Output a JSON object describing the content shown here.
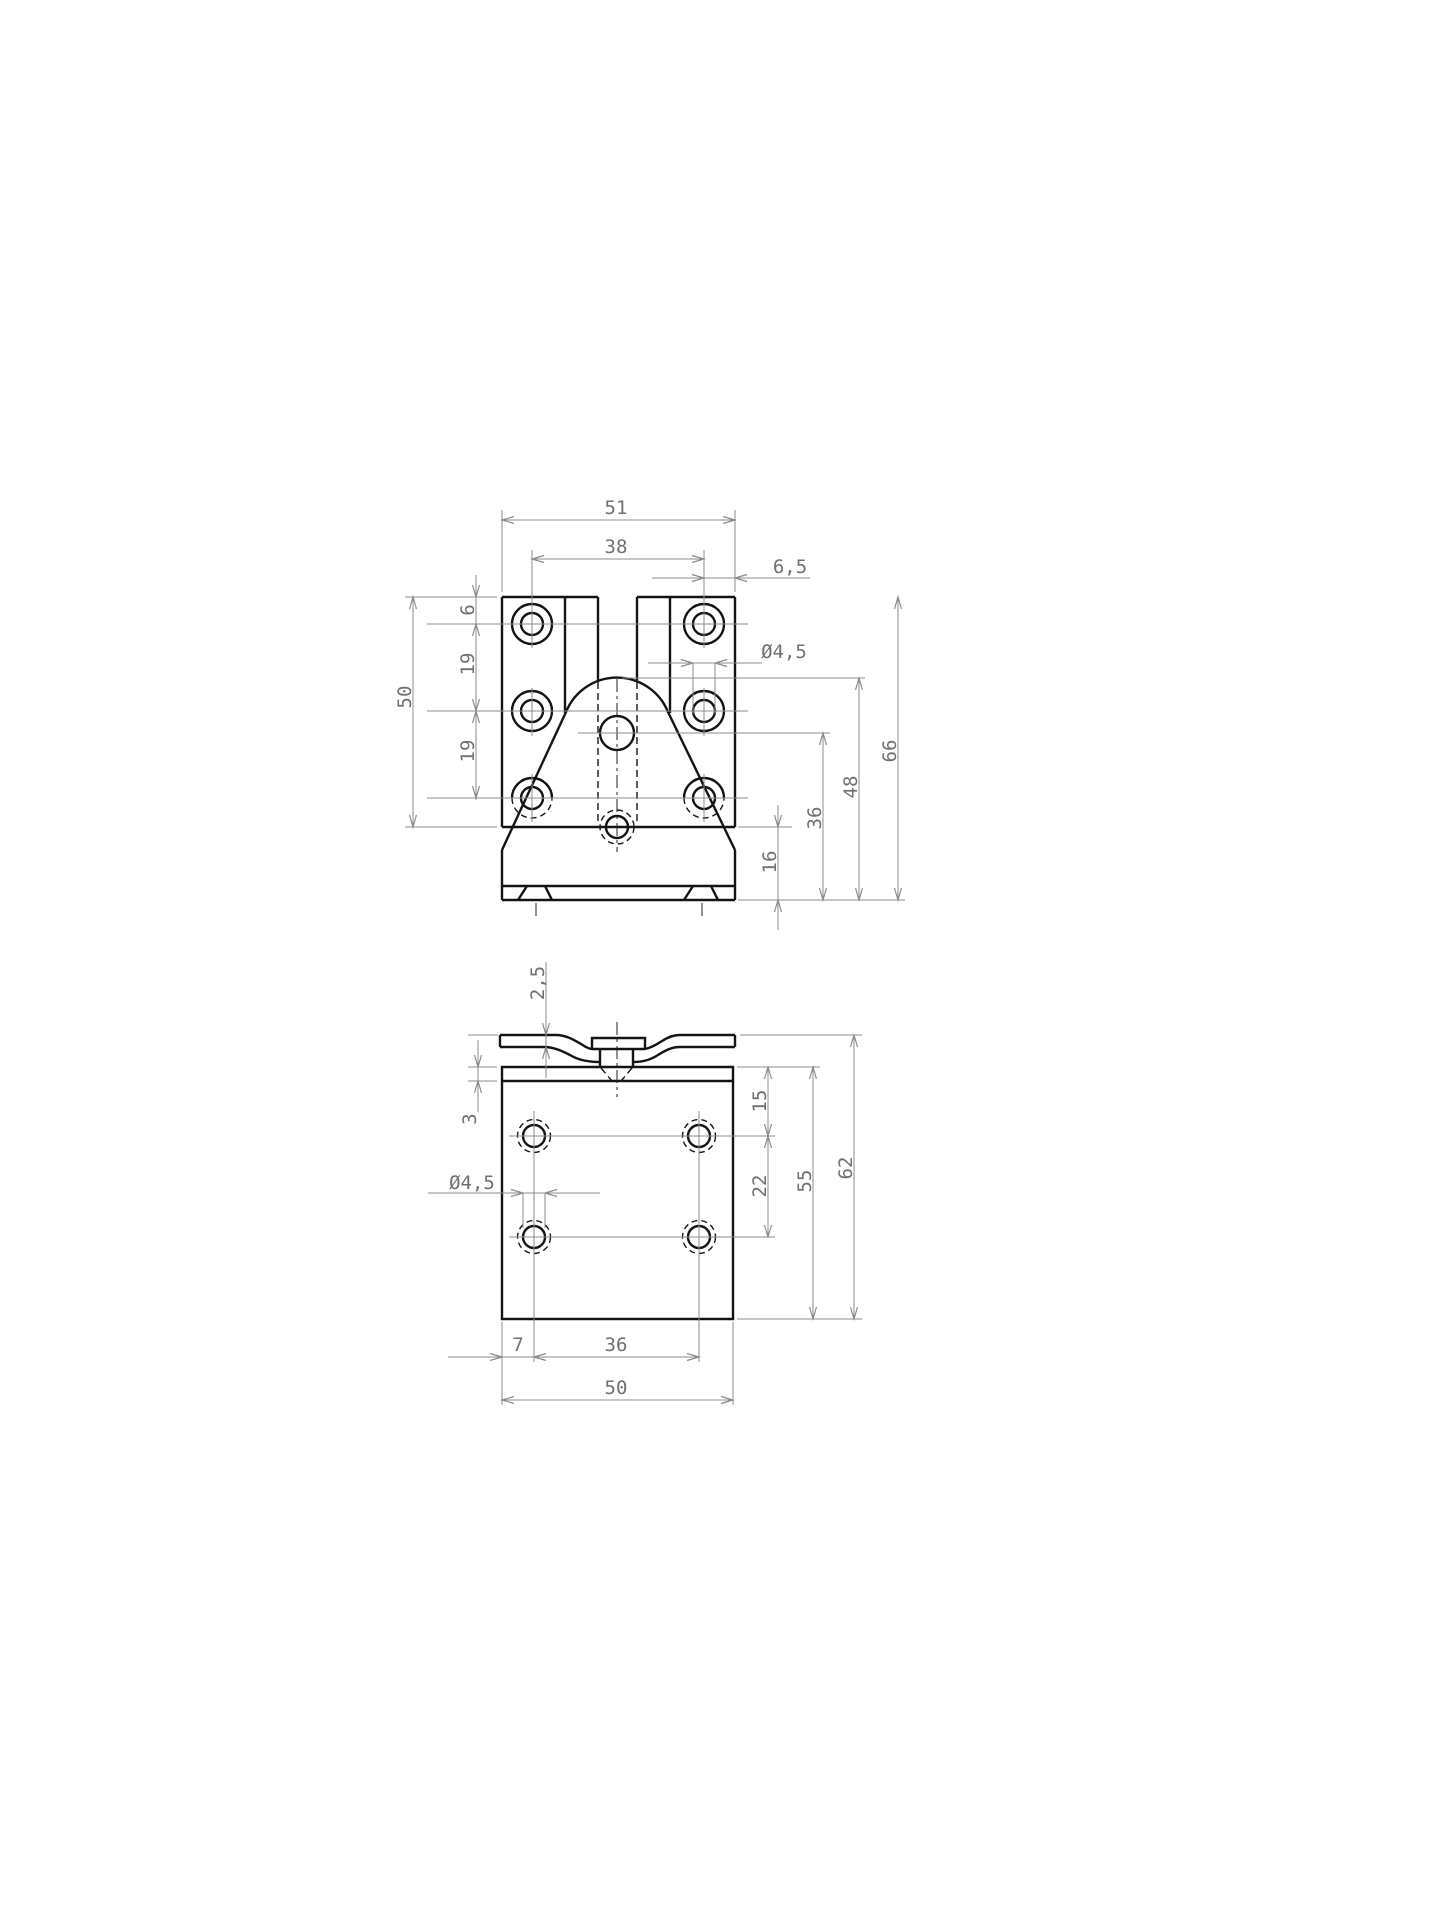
{
  "sheet": {
    "background": "#ffffff",
    "object_line_color": "#141414",
    "dimension_line_color": "#8c8c8c",
    "text_color": "#707070"
  },
  "front_view": {
    "dims": {
      "overall_width": "51",
      "hole_cols_width": "38",
      "right_offset": "6,5",
      "hole_diameter": "Ø4,5",
      "top_offset": "6",
      "row_gap_1": "19",
      "row_gap_2": "19",
      "hole_rows_height": "50",
      "overall_height": "66",
      "arch_height": "48",
      "center_hole_height": "36",
      "base_height": "16"
    }
  },
  "side_view": {
    "dims": {
      "flange_thickness": "2,5",
      "top_step": "3",
      "hole_diameter": "Ø4,5",
      "top_to_row1": "15",
      "row_gap": "22",
      "plate_height": "55",
      "overall_height": "62",
      "left_offset": "7",
      "hole_cols_width": "36",
      "overall_width": "50"
    }
  }
}
